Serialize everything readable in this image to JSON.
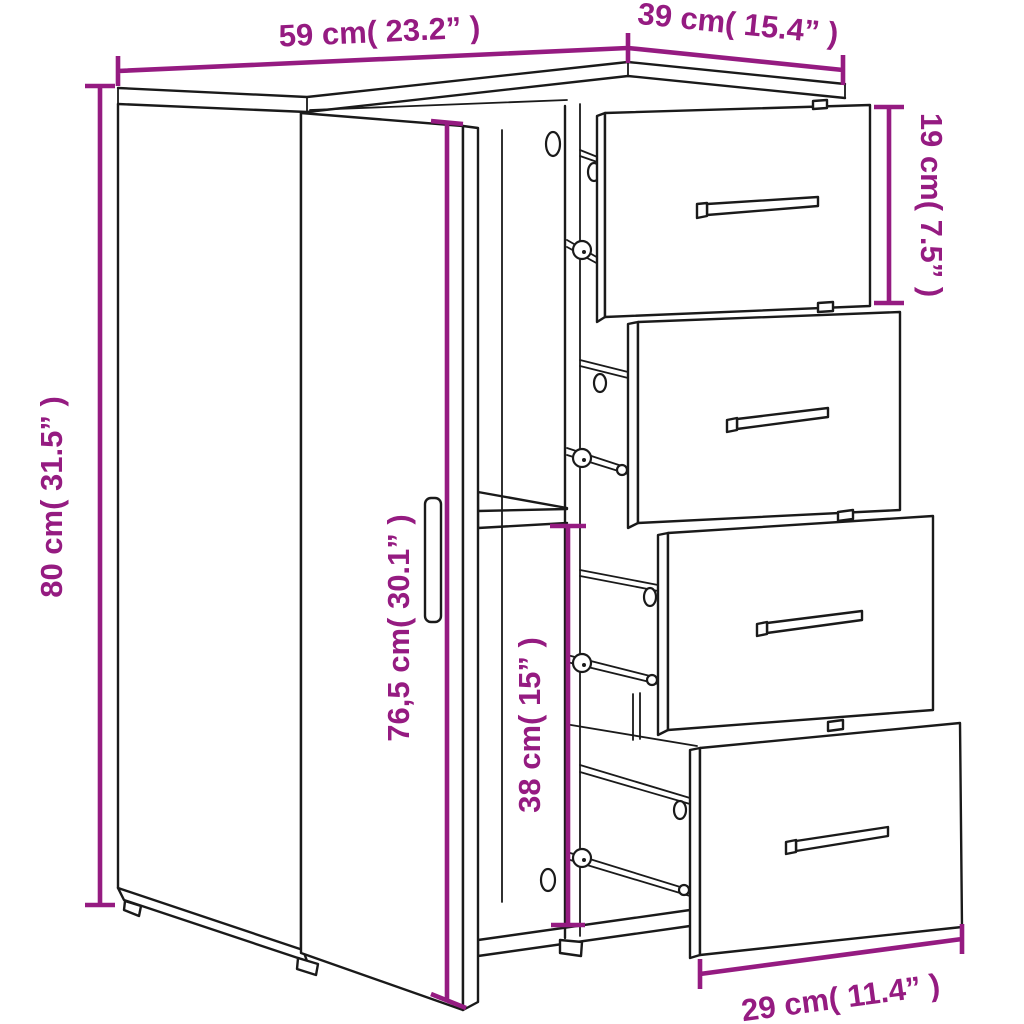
{
  "diagram": {
    "type": "furniture-dimension-diagram",
    "subject": "sideboard with open left door, interior shelf and four pulled-out drawers",
    "drawer_count": 4,
    "colors": {
      "dimension_accent": "#951b81",
      "line_art": "#1a1a1a",
      "background": "#ffffff"
    },
    "dimensions": {
      "width": {
        "label": "59 cm( 23.2” )"
      },
      "depth": {
        "label": "39 cm( 15.4” )"
      },
      "drawer_height": {
        "label": "19 cm( 7.5” )"
      },
      "height": {
        "label": "80 cm( 31.5” )"
      },
      "door_height": {
        "label": "76,5 cm( 30.1” )"
      },
      "compartment_height": {
        "label": "38 cm( 15” )"
      },
      "drawer_width": {
        "label": "29 cm( 11.4” )"
      }
    }
  }
}
